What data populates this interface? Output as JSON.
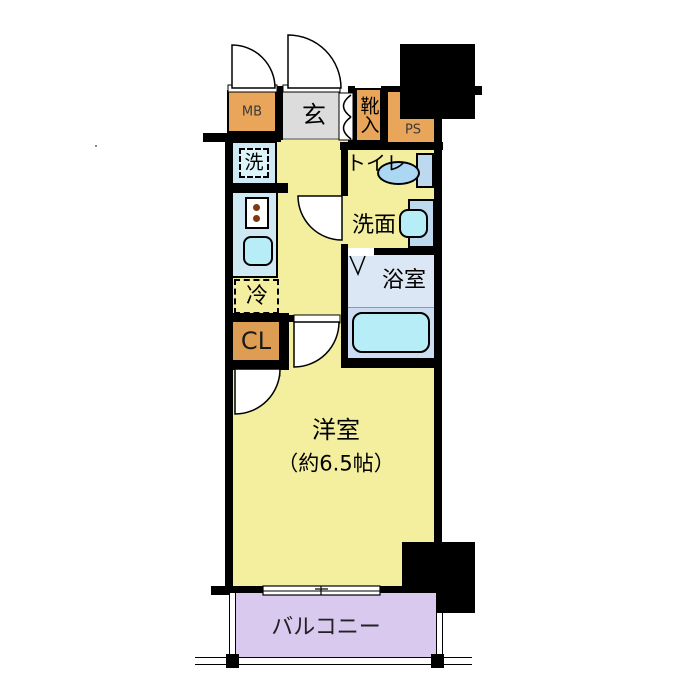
{
  "floorplan": {
    "rooms": {
      "mb": "MB",
      "genkan": "玄",
      "shoe_cabinet": "靴入",
      "ps": "PS",
      "washer": "洗",
      "toilet": "トイレ",
      "washroom": "洗面",
      "bathroom": "浴室",
      "fridge": "冷",
      "closet": "CL",
      "western_room_name": "洋室",
      "western_room_size": "（約6.5帖）",
      "balcony": "バルコニー"
    },
    "colors": {
      "wall": "#000000",
      "orange": "#e9a55a",
      "closet_orange": "#dd9d52",
      "floor_yellow": "#f4ef9f",
      "genkan_gray": "#dcdcdc",
      "fixture_blue": "#cfe9f4",
      "fixture_cyan": "#b7edf7",
      "bath_blue": "#dbe7f5",
      "bath_lower_blue": "#ccddf1",
      "sanitary_blue": "#bcd9f0",
      "balcony_purple": "#d9c9ef"
    }
  }
}
